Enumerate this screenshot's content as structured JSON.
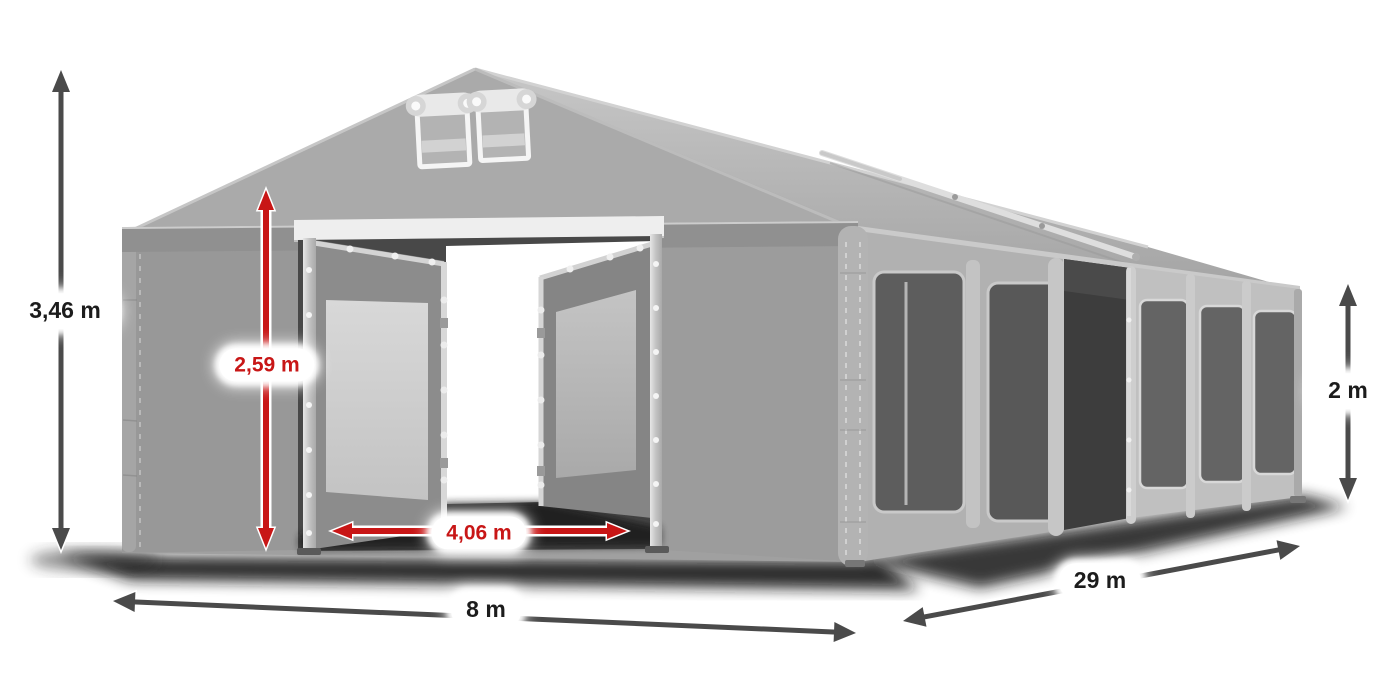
{
  "diagram": {
    "type": "product-dimension-diagram",
    "dimensions": {
      "ridge_height": {
        "value": "3,46 m",
        "color": "dark"
      },
      "entrance_height": {
        "value": "2,59 m",
        "color": "red"
      },
      "entrance_width": {
        "value": "4,06 m",
        "color": "red"
      },
      "front_width": {
        "value": "8 m",
        "color": "dark"
      },
      "length": {
        "value": "29 m",
        "color": "dark"
      },
      "side_height": {
        "value": "2 m",
        "color": "dark"
      }
    },
    "style": {
      "arrow_dark": "#4a4a4a",
      "arrow_red": "#c81616",
      "label_background": "#ffffff",
      "label_text_dark": "#1c1c1c",
      "tent_fabric_gray": "#a6a6a6",
      "frame_silver": "#d9d9d9",
      "interior_dark": "#474747"
    }
  }
}
